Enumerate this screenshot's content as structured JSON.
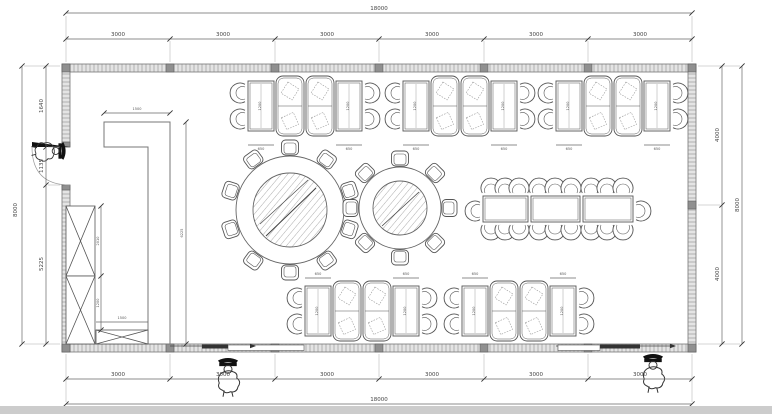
{
  "plan": {
    "dims_top": {
      "overall": "18000",
      "segments": [
        "3000",
        "3000",
        "3000",
        "3000",
        "3000",
        "3000"
      ]
    },
    "dims_bottom": {
      "overall": "18000",
      "segments": [
        "3000",
        "3000",
        "3000",
        "3000",
        "3000",
        "3000"
      ]
    },
    "dims_left": {
      "overall": "8000",
      "segments": [
        "1640",
        "1135",
        "5225"
      ]
    },
    "dims_right": {
      "overall": "8000",
      "segments": [
        "4000",
        "4000"
      ]
    },
    "dims_interior": {
      "counter_width": "1500",
      "counter_length": "6225",
      "cabinet_seg1": "2010",
      "cabinet_seg2": "1200",
      "cabinet_width": "1500",
      "booth_table_width": "650",
      "booth_table_length": "1200"
    },
    "colors": {
      "line": "#555555",
      "wall_window_fill": "#e8e8e8",
      "column_fill": "#909090",
      "dim_text": "#444444"
    }
  }
}
